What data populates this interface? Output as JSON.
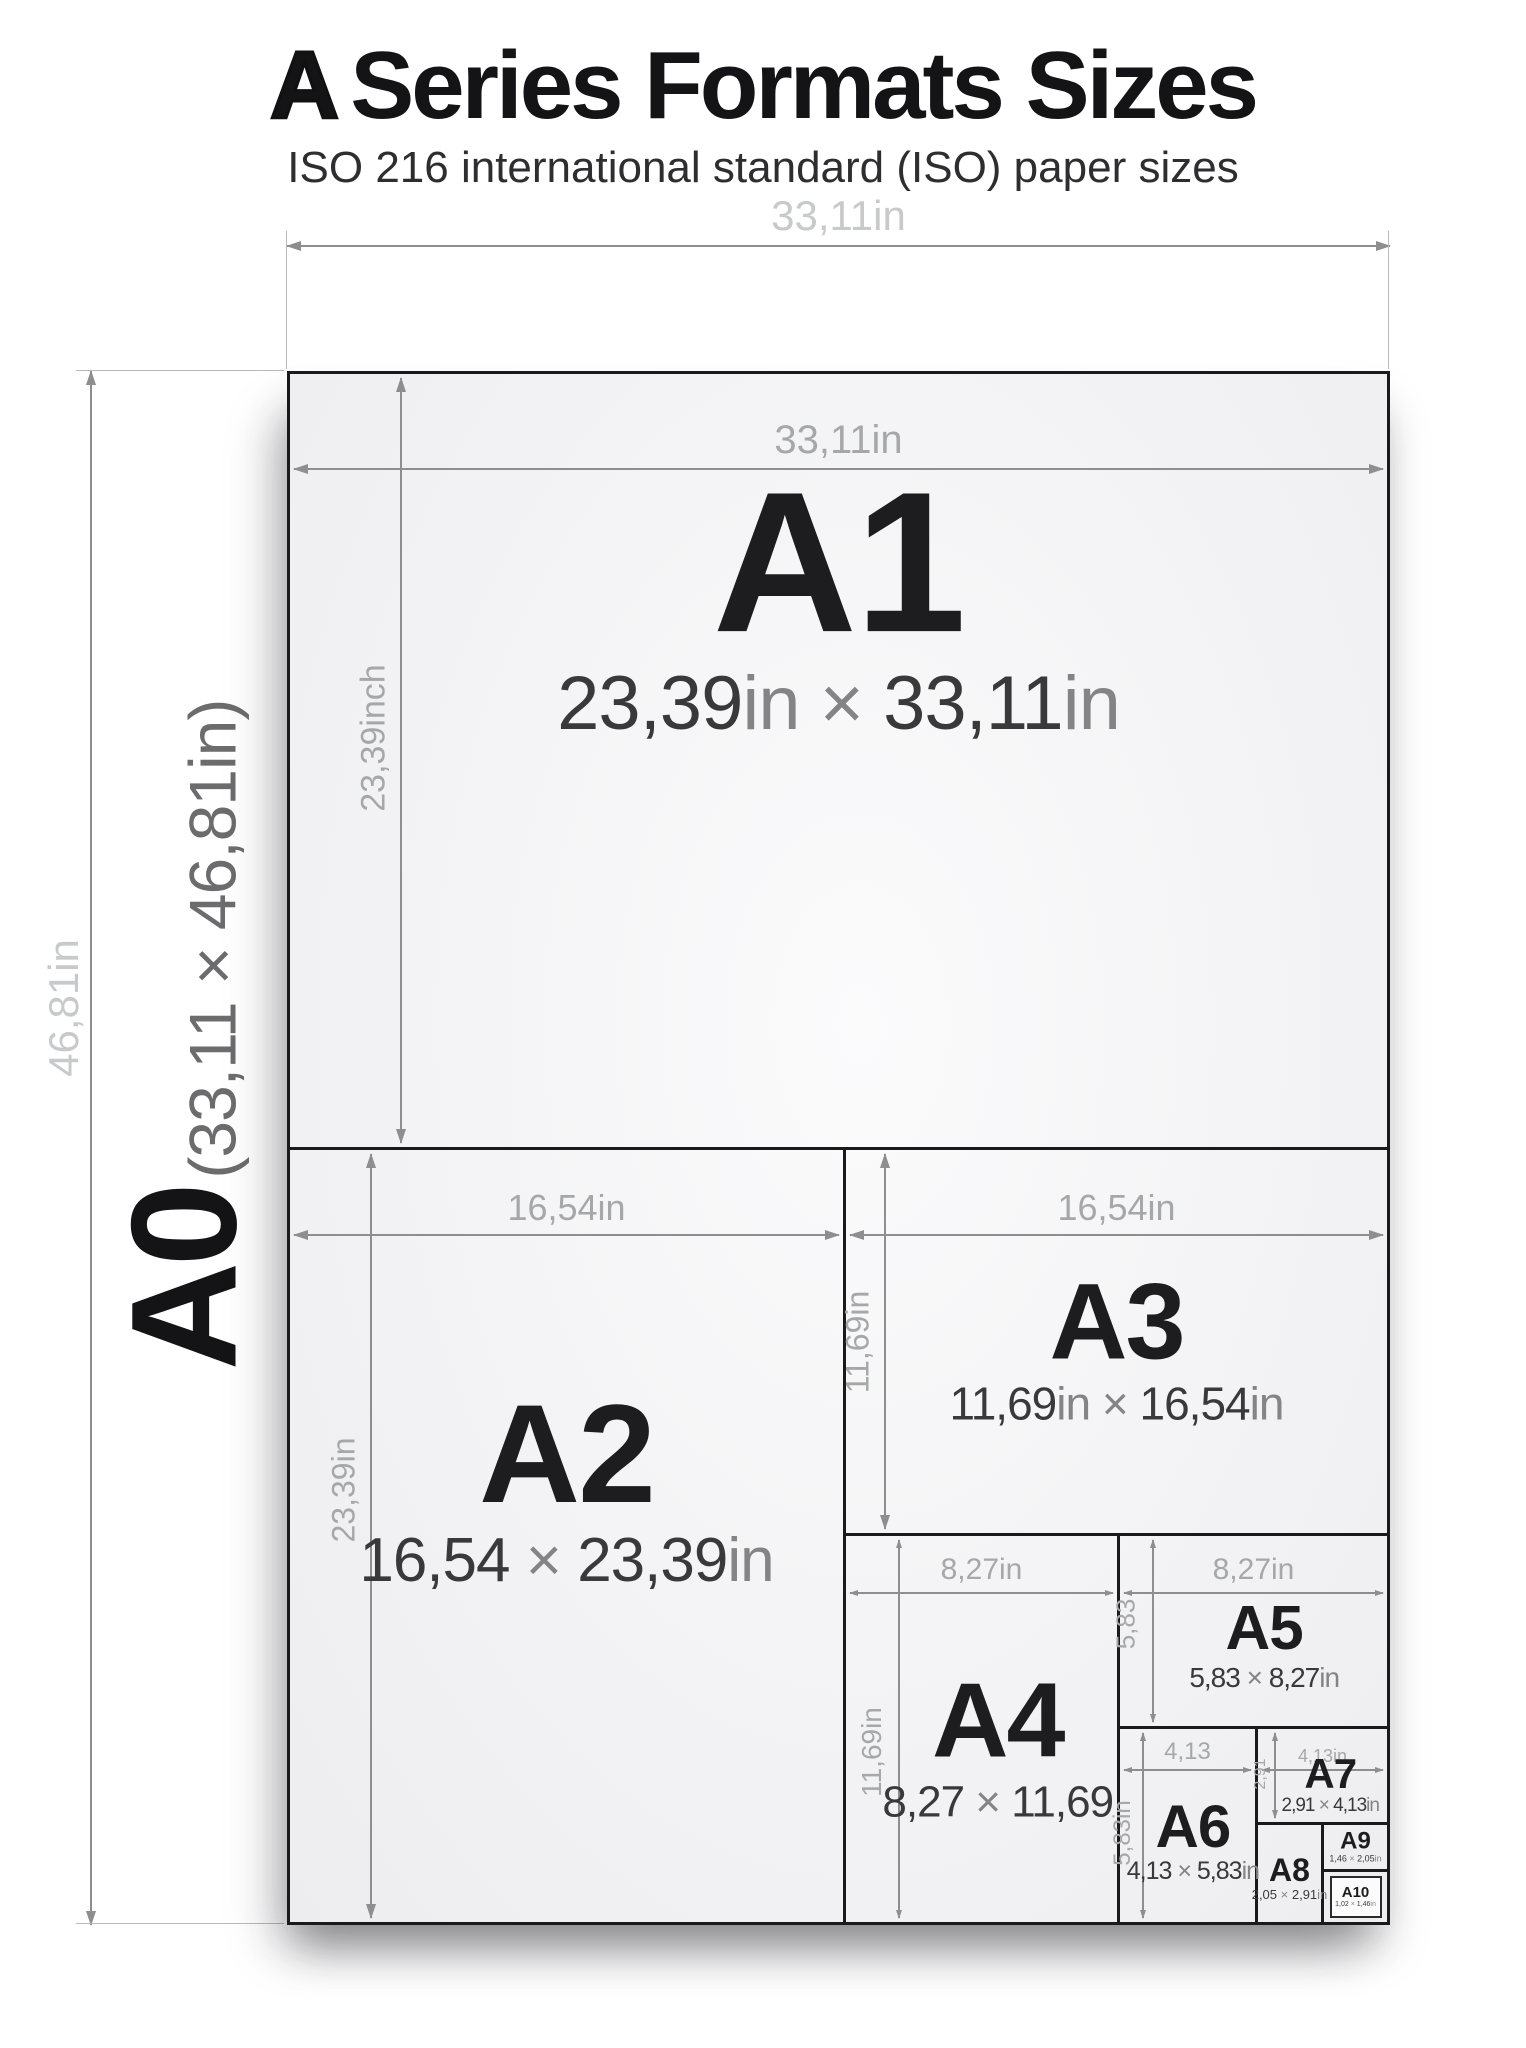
{
  "title": {
    "prefix": "A",
    "rest": "Series Formats Sizes"
  },
  "subtitle": "ISO 216 international standard (ISO) paper sizes",
  "colors": {
    "border_ink": "#1a1a1c",
    "arrow_gray": "#8e8e90",
    "label_light_gray": "#c8c9cb",
    "label_mid_gray": "#a6a7a9",
    "size_label_ink": "#1d1d1f",
    "paren_gray": "#6c6c6e"
  },
  "outer": {
    "label": "A0",
    "dims_paren": "(33,11 × 46,81in)",
    "width_label": "33,11in",
    "height_label": "46,81in"
  },
  "sheets": [
    {
      "id": "A1",
      "label": "A1",
      "dims": "23,39in × 33,11in",
      "width_label": "33,11in",
      "height_label": "23,39inch"
    },
    {
      "id": "A2",
      "label": "A2",
      "dims": "16,54 × 23,39in",
      "width_label": "16,54in",
      "height_label": "23,39in"
    },
    {
      "id": "A3",
      "label": "A3",
      "dims": "11,69in × 16,54in",
      "width_label": "16,54in",
      "height_label": "11,69in"
    },
    {
      "id": "A4",
      "label": "A4",
      "dims": "8,27 × 11,69",
      "width_label": "8,27in",
      "height_label": "11,69in"
    },
    {
      "id": "A5",
      "label": "A5",
      "dims": "5,83 × 8,27in",
      "width_label": "8,27in",
      "height_label": "5,83"
    },
    {
      "id": "A6",
      "label": "A6",
      "dims": "4,13 × 5,83in",
      "width_label": "4,13",
      "height_label": "5,83in"
    },
    {
      "id": "A7",
      "label": "A7",
      "dims": "2,91 × 4,13in",
      "width_label": "4,13in",
      "height_label": "2,91"
    },
    {
      "id": "A8",
      "label": "A8",
      "dims": "2,05 × 2,91in"
    },
    {
      "id": "A9",
      "label": "A9",
      "dims": "1,46 × 2,05in"
    },
    {
      "id": "A10",
      "label": "A10",
      "dims": "1,02 × 1,46in"
    }
  ]
}
